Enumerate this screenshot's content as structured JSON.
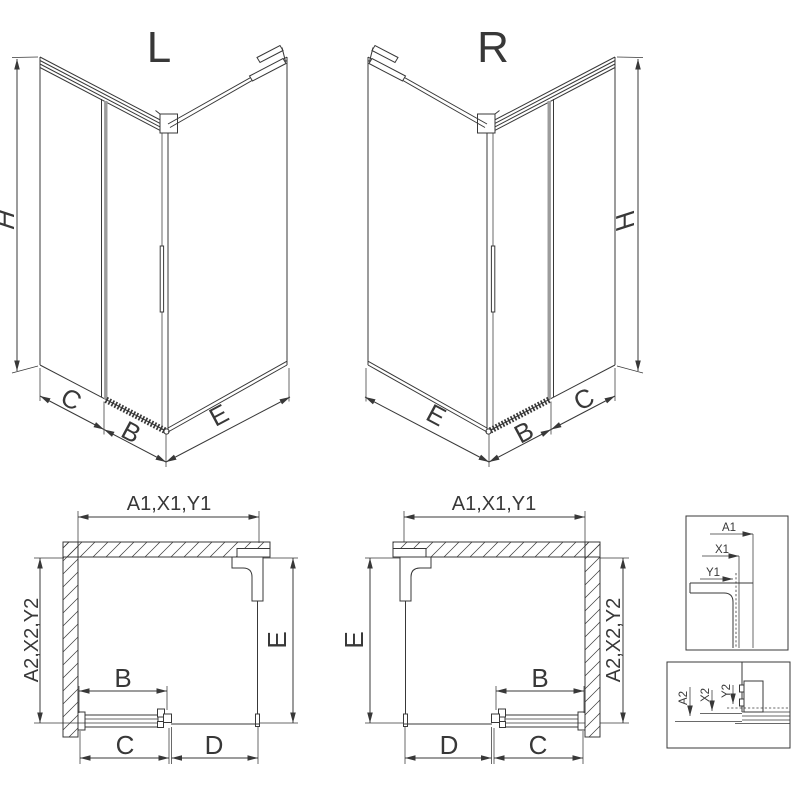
{
  "colors": {
    "line": "#383838",
    "glass_edge": "#9c9c9c",
    "background": "#ffffff"
  },
  "iso_left": {
    "title": "L",
    "h": "H",
    "c": "C",
    "b": "B",
    "e": "E"
  },
  "iso_right": {
    "title": "R",
    "h": "H",
    "c": "C",
    "b": "B",
    "e": "E"
  },
  "plan_left": {
    "top": "A1,X1,Y1",
    "side": "A2,X2,Y2",
    "e": "E",
    "b": "B",
    "c": "C",
    "d": "D"
  },
  "plan_right": {
    "top": "A1,X1,Y1",
    "side": "A2,X2,Y2",
    "e": "E",
    "b": "B",
    "c": "C",
    "d": "D"
  },
  "detail_top": {
    "a1": "A1",
    "x1": "X1",
    "y1": "Y1"
  },
  "detail_bottom": {
    "a2": "A2",
    "x2": "X2",
    "y2": "Y2"
  }
}
